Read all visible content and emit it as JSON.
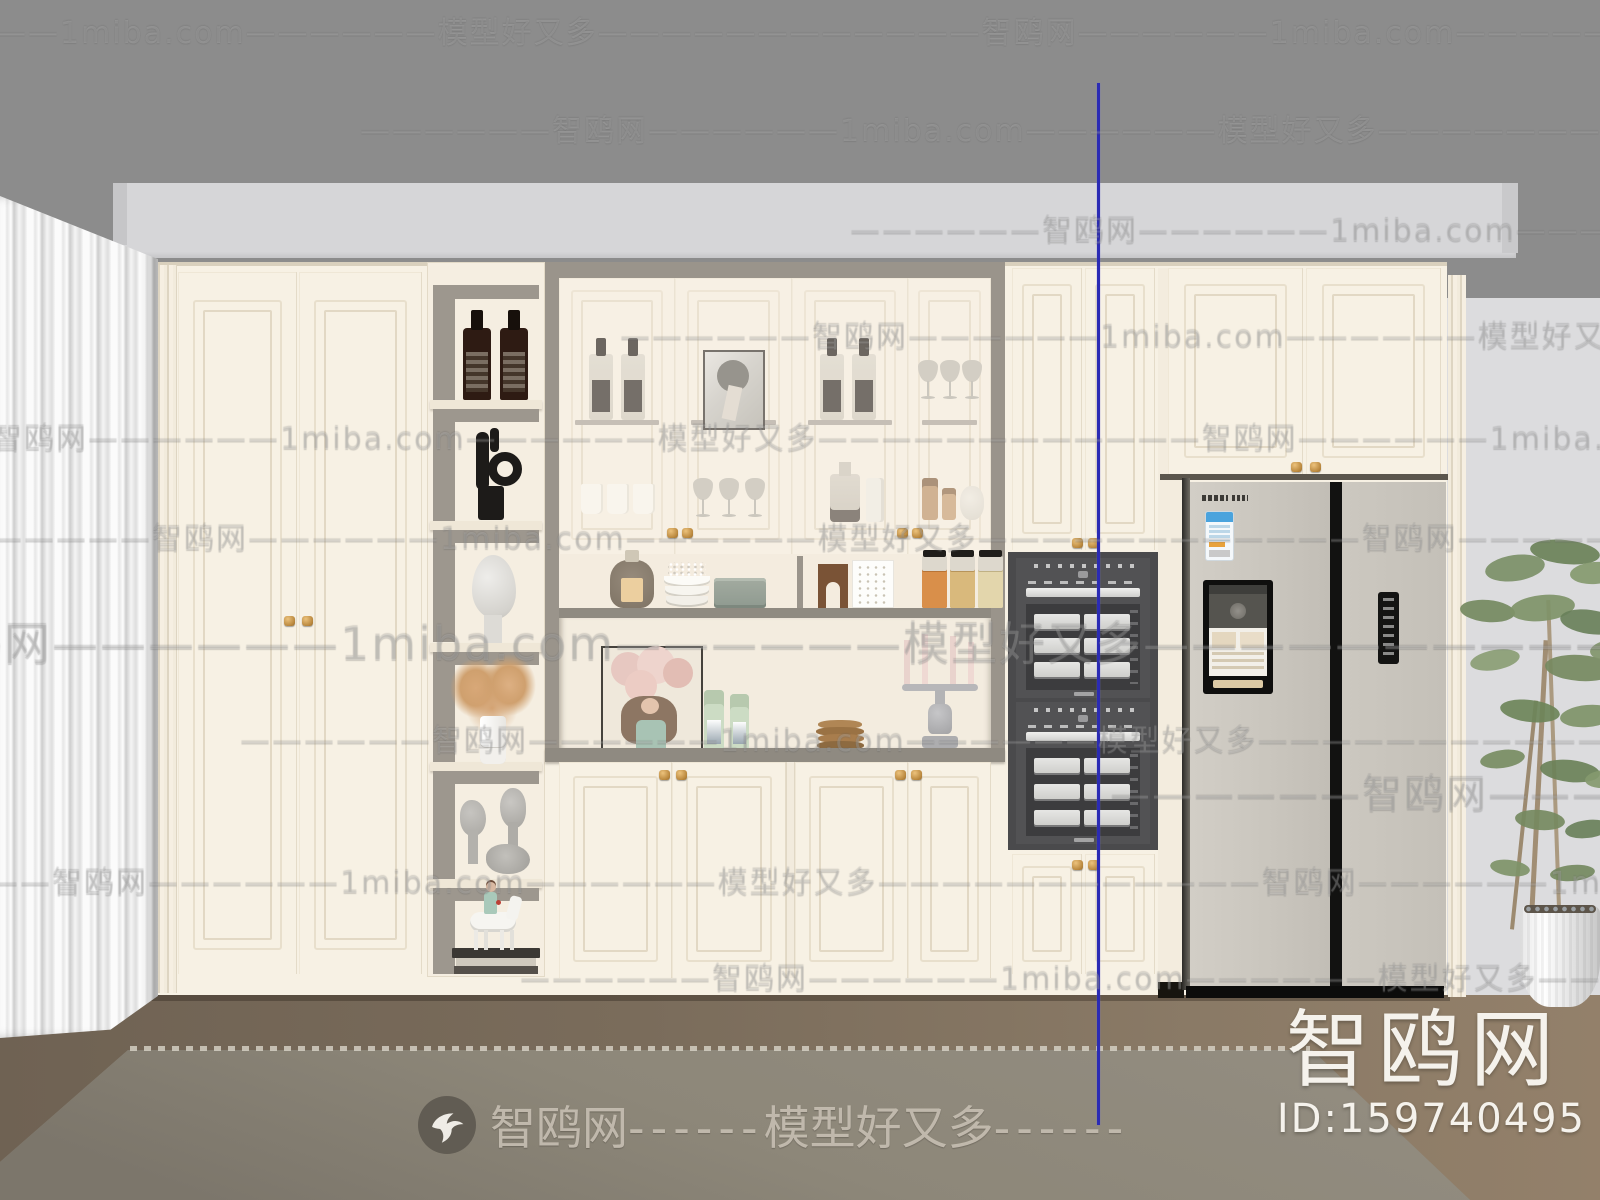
{
  "branding": {
    "site_name": "智鸥网",
    "site_domain": "1miba.com",
    "slogan": "模型好又多",
    "watermark_dashes": "——————",
    "bottom_dashes": "------",
    "corner_site_name": "智鸥网",
    "corner_id": "ID:159740495",
    "logo_icon": "swallow-bird-icon"
  },
  "colors": {
    "wall_upper": "#8c8c8c",
    "wall_side": "#dcdcde",
    "valance": "#d6d6d8",
    "cabinet_cream": "#f7f1e4",
    "molding_line": "#e2d8c4",
    "niche_gray": "#9a948b",
    "countertop_gray": "#8f8a81",
    "oven_dark": "#4a4a4c",
    "fridge_body": "#cac6bf",
    "floor_brown": "#796c5b",
    "rug_gray": "#8f897d",
    "knob_gold": "#c89a4e",
    "guide_line_blue": "#2b2bb4"
  }
}
